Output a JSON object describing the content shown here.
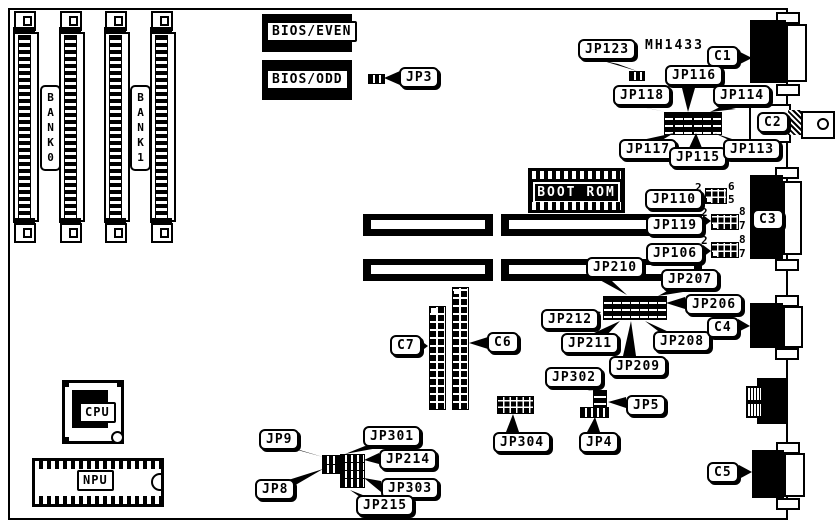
{
  "board": {
    "part_number": "MH1433"
  },
  "labels": {
    "bank0": "BANK0",
    "bank1": "BANK1",
    "bios_even": "BIOS/EVEN",
    "bios_odd": "BIOS/ODD",
    "boot_rom": "BOOT ROM",
    "cpu": "CPU",
    "npu": "NPU",
    "jp3": "JP3",
    "jp4": "JP4",
    "jp5": "JP5",
    "jp8": "JP8",
    "jp9": "JP9",
    "jp106": "JP106",
    "jp110": "JP110",
    "jp113": "JP113",
    "jp114": "JP114",
    "jp115": "JP115",
    "jp116": "JP116",
    "jp117": "JP117",
    "jp118": "JP118",
    "jp119": "JP119",
    "jp123": "JP123",
    "jp206": "JP206",
    "jp207": "JP207",
    "jp208": "JP208",
    "jp209": "JP209",
    "jp210": "JP210",
    "jp211": "JP211",
    "jp212": "JP212",
    "jp214": "JP214",
    "jp215": "JP215",
    "jp301": "JP301",
    "jp302": "JP302",
    "jp303": "JP303",
    "jp304": "JP304",
    "c1": "C1",
    "c2": "C2",
    "c3": "C3",
    "c4": "C4",
    "c5": "C5",
    "c6": "C6",
    "c7": "C7"
  },
  "pins": {
    "jp110": {
      "tl": "2",
      "tr": "6",
      "br": "5"
    },
    "jp119": {
      "tl": "2",
      "tr": "8",
      "br": "7"
    },
    "jp106": {
      "tl": "2",
      "tr": "8",
      "br": "7"
    }
  },
  "icons": {
    "bnc_pin": "circle"
  },
  "colors": {
    "ink": "#000000",
    "paper": "#ffffff"
  }
}
